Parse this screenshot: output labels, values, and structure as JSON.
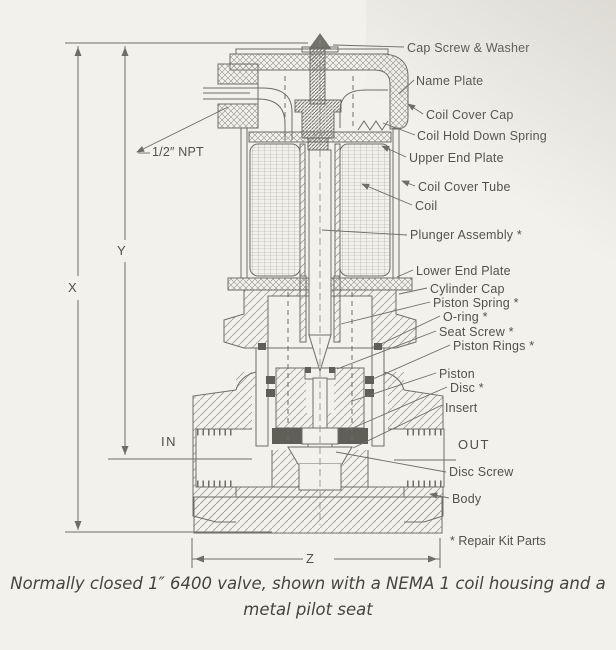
{
  "page": {
    "caption": {
      "line1": "Normally closed 1″ 6400 valve, shown with a NEMA 1 coil housing and a",
      "line2": "metal pilot seat"
    },
    "footnote": "* Repair Kit Parts",
    "dimensions": {
      "x": "X",
      "y": "Y",
      "z": "Z"
    },
    "ports": {
      "in": "IN",
      "out": "OUT"
    },
    "conduit_label": "1/2″ NPT",
    "parts": [
      {
        "label": "Cap Screw & Washer"
      },
      {
        "label": "Name Plate"
      },
      {
        "label": "Coil Cover Cap"
      },
      {
        "label": "Coil Hold Down Spring"
      },
      {
        "label": "Upper End Plate"
      },
      {
        "label": "Coil Cover Tube"
      },
      {
        "label": "Coil"
      },
      {
        "label": "Plunger Assembly *"
      },
      {
        "label": "Lower End Plate"
      },
      {
        "label": "Cylinder Cap"
      },
      {
        "label": "Piston Spring *"
      },
      {
        "label": "O-ring *"
      },
      {
        "label": "Seat Screw *"
      },
      {
        "label": "Piston Rings *"
      },
      {
        "label": "Piston"
      },
      {
        "label": "Disc *"
      },
      {
        "label": "Insert"
      },
      {
        "label": "Disc Screw"
      },
      {
        "label": "Body"
      }
    ],
    "colors": {
      "paper": "#f2f1ec",
      "ink": "#6e6d66",
      "text": "#52524d",
      "dark_fill": "#5f5f58"
    }
  }
}
